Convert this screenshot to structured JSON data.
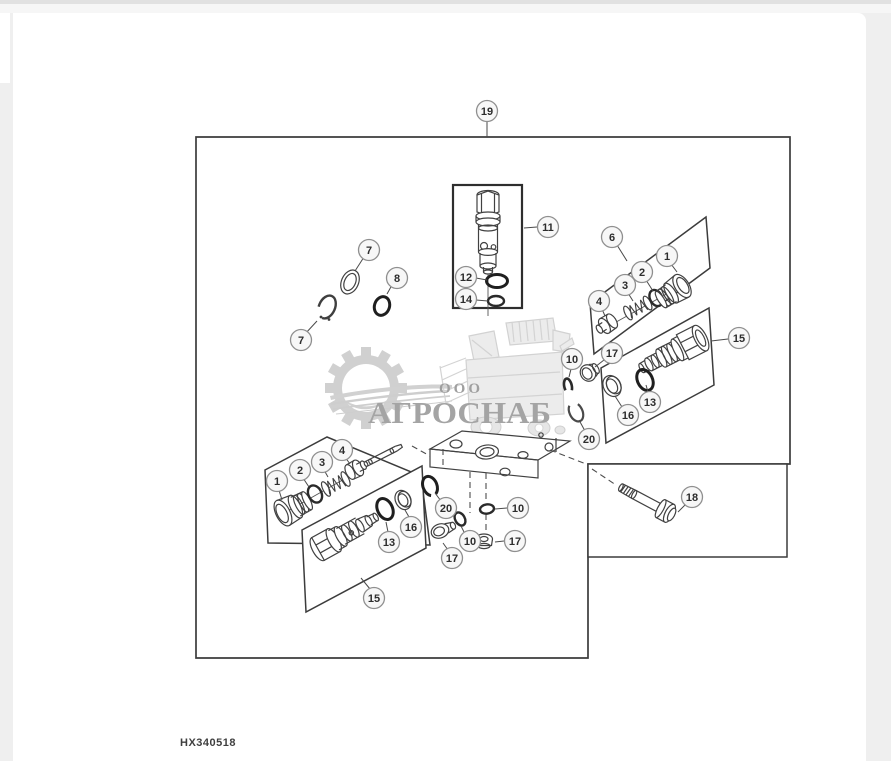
{
  "page": {
    "width": 891,
    "height": 761,
    "background_color": "#efefef",
    "top_strip_color": "#e1e1e1",
    "canvas_color": "#ffffff"
  },
  "watermark": {
    "org_form": "ООО",
    "company": "АГРОСНАБ",
    "text_color": "#a4a4a4"
  },
  "footer": {
    "drawing_number": "HX340518"
  },
  "diagram": {
    "line_color": "#3c3c3c",
    "callout_style": {
      "radius": 10.5,
      "ring_color": "#8f8f8f",
      "fill": "#f7f7f7",
      "text_color": "#2d2d2d"
    },
    "callouts": [
      {
        "id": "callout-19",
        "label": "19",
        "x": 487,
        "y": 111,
        "leader": [
          487,
          121,
          487,
          137
        ]
      },
      {
        "id": "callout-11",
        "label": "11",
        "x": 548,
        "y": 227,
        "leader": [
          537,
          227,
          524,
          228
        ]
      },
      {
        "id": "callout-12",
        "label": "12",
        "x": 466,
        "y": 277,
        "leader": [
          476,
          278,
          487,
          280
        ]
      },
      {
        "id": "callout-14",
        "label": "14",
        "x": 466,
        "y": 299,
        "leader": [
          476,
          300,
          488,
          301
        ]
      },
      {
        "id": "callout-7-upper",
        "label": "7",
        "x": 369,
        "y": 250,
        "leader": [
          364,
          257,
          355,
          271
        ]
      },
      {
        "id": "callout-8",
        "label": "8",
        "x": 397,
        "y": 278,
        "leader": [
          392,
          285,
          387,
          294
        ]
      },
      {
        "id": "callout-7-lower",
        "label": "7",
        "x": 301,
        "y": 340,
        "leader": [
          305,
          334,
          317,
          321
        ]
      },
      {
        "id": "callout-6",
        "label": "6",
        "x": 612,
        "y": 237,
        "leader": [
          617,
          245,
          627,
          261
        ]
      },
      {
        "id": "callout-1-right",
        "label": "1",
        "x": 667,
        "y": 256,
        "leader": [
          671,
          264,
          677,
          272
        ]
      },
      {
        "id": "callout-2-right",
        "label": "2",
        "x": 642,
        "y": 272,
        "leader": [
          646,
          280,
          653,
          291
        ]
      },
      {
        "id": "callout-3-right",
        "label": "3",
        "x": 625,
        "y": 285,
        "leader": [
          628,
          293,
          633,
          301
        ]
      },
      {
        "id": "callout-4-right",
        "label": "4",
        "x": 599,
        "y": 301,
        "leader": [
          602,
          309,
          605,
          316
        ]
      },
      {
        "id": "callout-15-right",
        "label": "15",
        "x": 739,
        "y": 338,
        "leader": [
          728,
          339,
          711,
          341
        ]
      },
      {
        "id": "callout-13-right",
        "label": "13",
        "x": 650,
        "y": 402,
        "leader": [
          648,
          392,
          646,
          385
        ]
      },
      {
        "id": "callout-16-right",
        "label": "16",
        "x": 628,
        "y": 415,
        "leader": [
          622,
          407,
          615,
          396
        ]
      },
      {
        "id": "callout-17-right",
        "label": "17",
        "x": 612,
        "y": 353,
        "leader": [
          604,
          360,
          595,
          367
        ]
      },
      {
        "id": "callout-10-right",
        "label": "10",
        "x": 572,
        "y": 359,
        "leader": [
          571,
          369,
          569,
          377
        ]
      },
      {
        "id": "callout-20-right",
        "label": "20",
        "x": 589,
        "y": 439,
        "leader": [
          585,
          431,
          579,
          420
        ]
      },
      {
        "id": "callout-1-left",
        "label": "1",
        "x": 277,
        "y": 481,
        "leader": [
          278,
          487,
          282,
          500
        ]
      },
      {
        "id": "callout-2-left",
        "label": "2",
        "x": 300,
        "y": 470,
        "leader": [
          303,
          478,
          309,
          487
        ]
      },
      {
        "id": "callout-3-left",
        "label": "3",
        "x": 322,
        "y": 462,
        "leader": [
          324,
          470,
          328,
          477
        ]
      },
      {
        "id": "callout-4-left",
        "label": "4",
        "x": 342,
        "y": 450,
        "leader": [
          345,
          457,
          350,
          464
        ]
      },
      {
        "id": "callout-13-left",
        "label": "13",
        "x": 389,
        "y": 542,
        "leader": [
          388,
          532,
          386,
          522
        ]
      },
      {
        "id": "callout-16-left",
        "label": "16",
        "x": 411,
        "y": 527,
        "leader": [
          409,
          517,
          405,
          510
        ]
      },
      {
        "id": "callout-15-left",
        "label": "15",
        "x": 374,
        "y": 598,
        "leader": [
          370,
          589,
          361,
          578
        ]
      },
      {
        "id": "callout-20-center",
        "label": "20",
        "x": 446,
        "y": 508,
        "leader": [
          441,
          501,
          435,
          493
        ]
      },
      {
        "id": "callout-10-center-a",
        "label": "10",
        "x": 518,
        "y": 508,
        "leader": [
          507,
          508,
          495,
          509
        ]
      },
      {
        "id": "callout-10-center-b",
        "label": "10",
        "x": 470,
        "y": 541,
        "leader": [
          465,
          534,
          461,
          526
        ]
      },
      {
        "id": "callout-17-center-a",
        "label": "17",
        "x": 515,
        "y": 541,
        "leader": [
          504,
          541,
          495,
          542
        ]
      },
      {
        "id": "callout-17-center-b",
        "label": "17",
        "x": 452,
        "y": 558,
        "leader": [
          448,
          550,
          443,
          543
        ]
      },
      {
        "id": "callout-18",
        "label": "18",
        "x": 692,
        "y": 497,
        "leader": [
          686,
          504,
          678,
          512
        ]
      }
    ]
  }
}
